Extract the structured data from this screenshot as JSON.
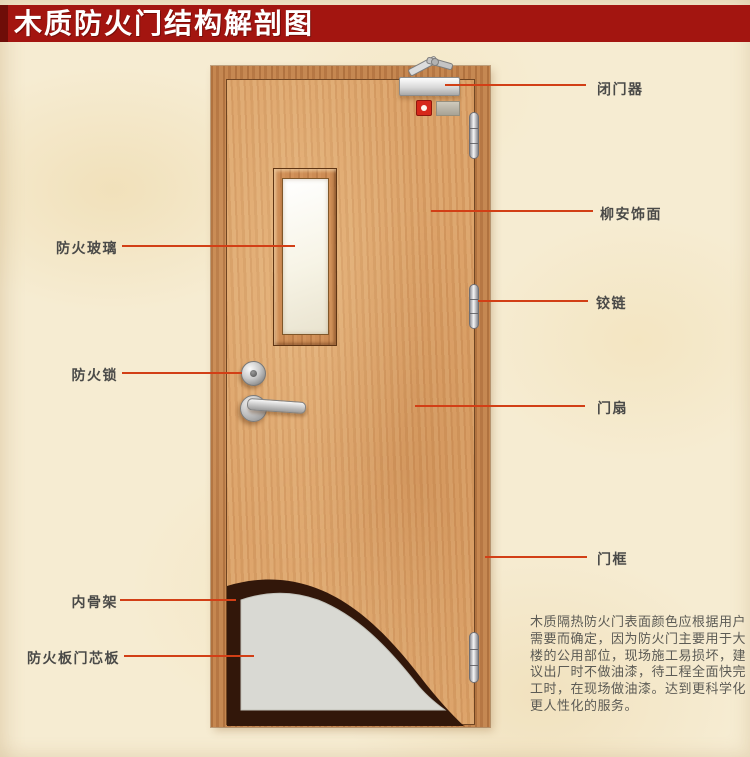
{
  "title": "木质防火门结构解剖图",
  "labels": {
    "left": [
      {
        "id": "fire-glass",
        "text": "防火玻璃"
      },
      {
        "id": "fire-lock",
        "text": "防火锁"
      },
      {
        "id": "inner-skeleton",
        "text": "内骨架"
      },
      {
        "id": "fire-board-core",
        "text": "防火板门芯板"
      }
    ],
    "right": [
      {
        "id": "door-closer",
        "text": "闭门器"
      },
      {
        "id": "lauan-veneer",
        "text": "柳安饰面"
      },
      {
        "id": "hinge",
        "text": "铰链"
      },
      {
        "id": "door-leaf",
        "text": "门扇"
      },
      {
        "id": "door-frame",
        "text": "门框"
      }
    ]
  },
  "description": {
    "lines": [
      "木质隔热防火门表面颜色应根据用户",
      "需要而确定，因为防火门主要用于大",
      "楼的公用部位，现场施工易损坏，建",
      "议出厂时不做油漆，待工程全面快完",
      "工时，在现场做油漆。达到更科学化",
      "更人性化的服务。"
    ]
  },
  "colors": {
    "banner": "#a31510",
    "banner_edge": "#6f0d08",
    "pointer_line": "#d23f16",
    "label_text": "#4a4a48",
    "frame_wood": "#c0804a",
    "leaf_wood": "#daa067",
    "core_board_gray": "#d9d9d3",
    "inner_skeleton_dark": "#32170a",
    "background": "#f6ecd2"
  }
}
